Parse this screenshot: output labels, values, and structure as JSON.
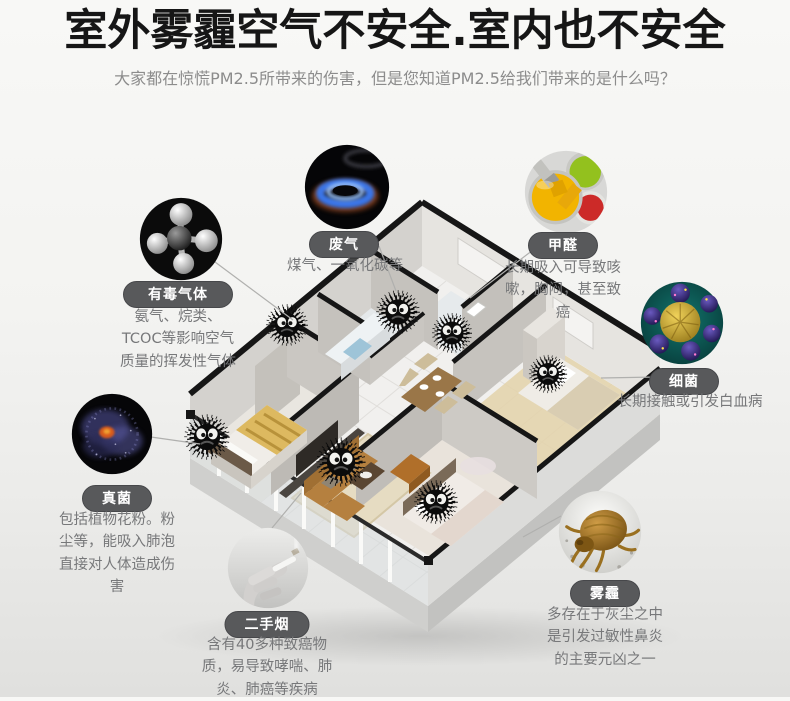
{
  "header": {
    "title": "室外雾霾空气不安全.室内也不安全",
    "subtitle": "大家都在惊慌PM2.5所带来的伤害，但是您知道PM2.5给我们带来的是什么吗？"
  },
  "callouts": [
    {
      "id": "toxic-gas",
      "label": "有毒气体",
      "icon": "molecule-icon",
      "lines": [
        "氨气、烷类、",
        "TCOC等影响空气",
        "质量的挥发性气体"
      ]
    },
    {
      "id": "waste-gas",
      "label": "废气",
      "icon": "gas-flame-icon",
      "lines": [
        "煤气、一氧化碳等"
      ]
    },
    {
      "id": "formaldehyde",
      "label": "甲醛",
      "icon": "paint-cans-icon",
      "lines": [
        "长期吸入可导致咳",
        "嗽，胸闷，甚至致",
        "癌"
      ]
    },
    {
      "id": "bacteria",
      "label": "细菌",
      "icon": "bacteria-icon",
      "lines": [
        "长期接触或引发白血病"
      ]
    },
    {
      "id": "fungus",
      "label": "真菌",
      "icon": "fungus-icon",
      "lines": [
        "包括植物花粉。粉",
        "尘等，能吸入肺泡",
        "直接对人体造成伤",
        "害"
      ]
    },
    {
      "id": "secondhand-smoke",
      "label": "二手烟",
      "icon": "smoking-hand-icon",
      "lines": [
        "含有40多种致癌物",
        "质，易导致哮喘、肺",
        "炎、肺癌等疾病"
      ]
    },
    {
      "id": "smog",
      "label": "雾霾",
      "icon": "dust-mite-icon",
      "lines": [
        "多存在于灰尘之中",
        "是引发过敏性鼻炎",
        "的主要元凶之一"
      ]
    }
  ],
  "scene": {
    "dust_monster_count": 7
  },
  "colors": {
    "title": "#161616",
    "subtitle": "#8c8c8c",
    "pill_bg": "#58595b",
    "pill_text": "#ffffff",
    "desc_text": "#77787a",
    "wall_cap": "#161616",
    "flame_blue": "#3a76e8",
    "paint_yellow": "#f2b400",
    "paint_green": "#93c11e",
    "paint_red": "#cc2a28",
    "bacteria_teal": "#0e6b68",
    "mite_brown": "#b0813a",
    "monster_black": "#0b0b0b"
  }
}
